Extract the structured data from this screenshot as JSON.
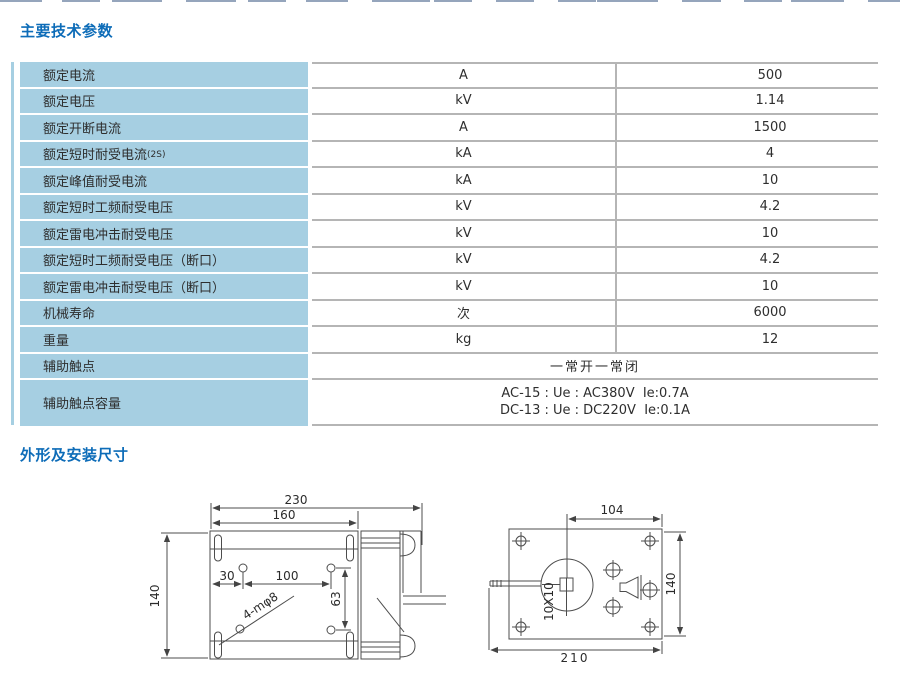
{
  "page": {
    "title_params": "主要技术参数",
    "title_dims": "外形及安装尺寸"
  },
  "table": {
    "rows": [
      {
        "label": "额定电流",
        "unit": "A",
        "value": "500"
      },
      {
        "label": "额定电压",
        "unit": "kV",
        "value": "1.14"
      },
      {
        "label": "额定开断电流",
        "unit": "A",
        "value": "1500"
      },
      {
        "label": "额定短时耐受电流",
        "label_note": "(2S)",
        "unit": "kA",
        "value": "4"
      },
      {
        "label": "额定峰值耐受电流",
        "unit": "kA",
        "value": "10"
      },
      {
        "label": "额定短时工频耐受电压",
        "unit": "kV",
        "value": "4.2"
      },
      {
        "label": "额定雷电冲击耐受电压",
        "unit": "kV",
        "value": "10"
      },
      {
        "label": "额定短时工频耐受电压（断口）",
        "unit": "kV",
        "value": "4.2"
      },
      {
        "label": "额定雷电冲击耐受电压（断口）",
        "unit": "kV",
        "value": "10"
      },
      {
        "label": "机械寿命",
        "unit": "次",
        "value": "6000"
      },
      {
        "label": "重量",
        "unit": "kg",
        "value": "12"
      },
      {
        "label": "辅助触点",
        "span": "一常开一常闭"
      },
      {
        "label": "辅助触点容量",
        "span_lines": [
          "AC-15 : Ue : AC380V  Ie:0.7A",
          "DC-13 : Ue : DC220V  Ie:0.1A"
        ]
      }
    ]
  },
  "drawings": {
    "front_view": {
      "dim_overall_width": "230",
      "dim_plate_width": "160",
      "dim_height": "140",
      "dim_hole_offset": "30",
      "dim_hole_spacing": "100",
      "dim_hole_vspacing": "63",
      "holes_label": "4-mφ8"
    },
    "rear_view": {
      "dim_top": "104",
      "dim_right": "140",
      "dim_bottom": "210",
      "shaft_label": "10X10"
    }
  },
  "colors": {
    "title_blue": "#0d6cb8",
    "cell_blue": "#a6cfe2",
    "border_gray": "#b5b5b5"
  }
}
